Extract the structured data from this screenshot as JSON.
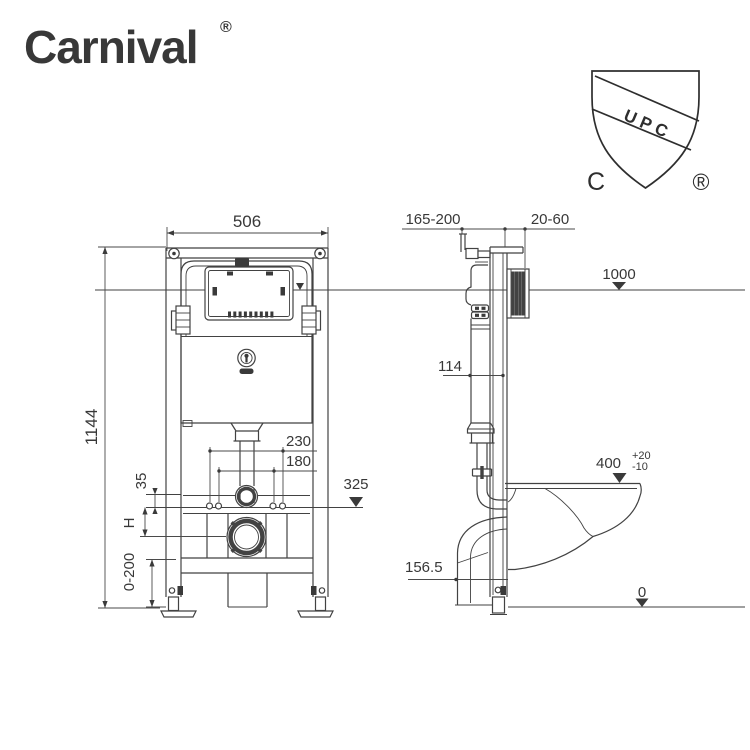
{
  "page": {
    "background": "#ffffff",
    "line_color": "#424242",
    "text_color": "#383838"
  },
  "brand": {
    "name": "Carnival",
    "registered": "®",
    "color": "#d6195c"
  },
  "certification": {
    "label": "UPC",
    "left_mark": "C",
    "registered": "®"
  },
  "front_view": {
    "labels": {
      "frame_width": "506",
      "frame_height": "1144",
      "fixing_spacing_outer": "230",
      "fixing_spacing_inner": "180",
      "offset": "35",
      "variable_height": "H",
      "leg_adjustment": "0-200",
      "flush_bend_level": "325"
    }
  },
  "side_view": {
    "labels": {
      "install_depth": "165-200",
      "wall_clearance": "20-60",
      "button_level": "1000",
      "tank_depth": "114",
      "bowl_top_level": "400",
      "bowl_tolerance_plus": "+20",
      "bowl_tolerance_minus": "-10",
      "drain_level": "156.5",
      "floor_level": "0"
    }
  }
}
